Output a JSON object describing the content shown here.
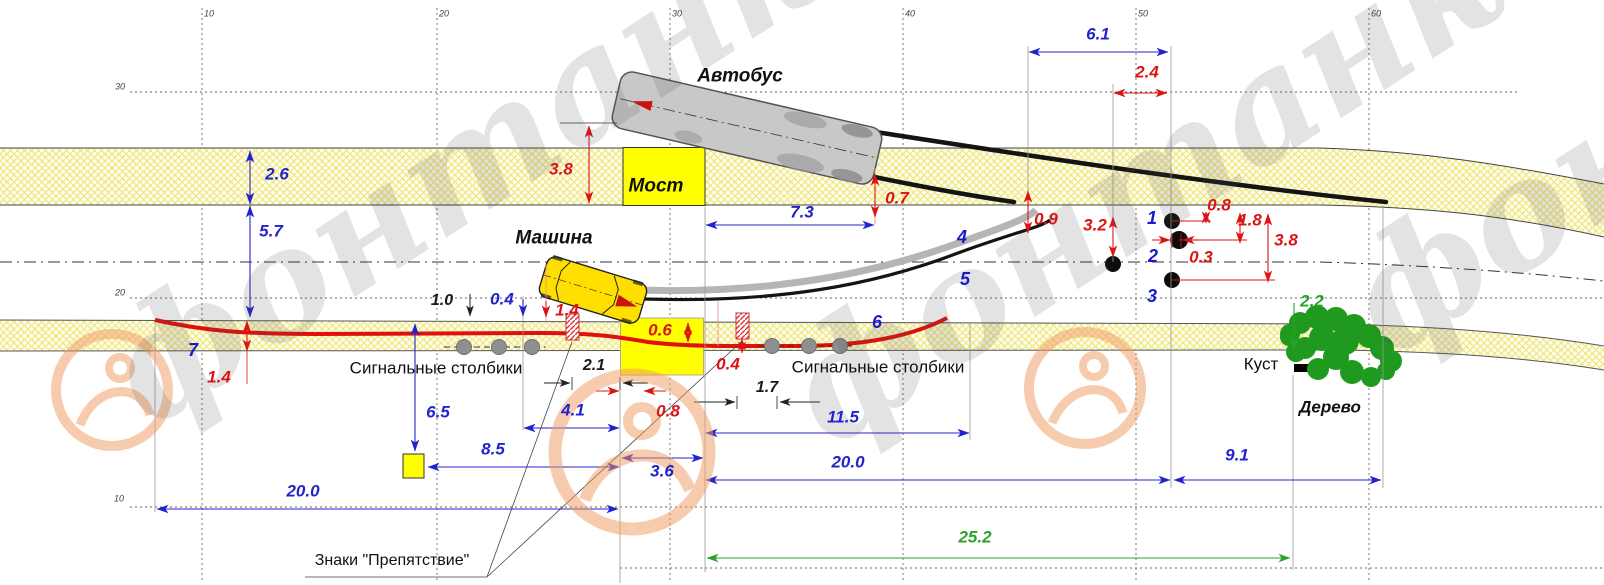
{
  "watermark": {
    "text": "фонтанка.ру"
  },
  "colors": {
    "dimension_blue": "#2323cd",
    "dimension_red": "#dc1414",
    "dimension_green": "#2ba22b",
    "road_fill": "#fffdf0",
    "bridge_yellow": "#ffff00",
    "trajectory_red": "#e01010"
  },
  "axis": {
    "x_ticks": [
      "10",
      "20",
      "30",
      "40",
      "50",
      "60"
    ],
    "y_ticks": [
      "30",
      "20",
      "10"
    ]
  },
  "objects": {
    "bus": "Автобус",
    "bridge": "Мост",
    "car": "Машина",
    "posts": "Сигнальные столбики",
    "obstacle_signs": "Знаки \"Препятствие\"",
    "bush": "Куст",
    "tree": "Дерево"
  },
  "points": [
    "1",
    "2",
    "3"
  ],
  "trajectories": [
    "4",
    "5",
    "6",
    "7"
  ],
  "labels": [
    {
      "id": "axis-x-10",
      "text": "10",
      "x": 209,
      "y": 14,
      "cls": "grid"
    },
    {
      "id": "axis-x-20",
      "text": "20",
      "x": 444,
      "y": 14,
      "cls": "grid"
    },
    {
      "id": "axis-x-30",
      "text": "30",
      "x": 677,
      "y": 14,
      "cls": "grid"
    },
    {
      "id": "axis-x-40",
      "text": "40",
      "x": 910,
      "y": 14,
      "cls": "grid"
    },
    {
      "id": "axis-x-50",
      "text": "50",
      "x": 1143,
      "y": 14,
      "cls": "grid"
    },
    {
      "id": "axis-x-60",
      "text": "60",
      "x": 1376,
      "y": 14,
      "cls": "grid"
    },
    {
      "id": "axis-y-30",
      "text": "30",
      "x": 120,
      "y": 87,
      "cls": "grid"
    },
    {
      "id": "axis-y-20",
      "text": "20",
      "x": 120,
      "y": 293,
      "cls": "grid"
    },
    {
      "id": "axis-y-10",
      "text": "10",
      "x": 119,
      "y": 499,
      "cls": "grid"
    },
    {
      "id": "label-bus",
      "text": "Автобус",
      "x": 740,
      "y": 76,
      "cls": "name"
    },
    {
      "id": "label-bridge",
      "text": "Мост",
      "x": 656,
      "y": 186,
      "cls": "name"
    },
    {
      "id": "label-car",
      "text": "Машина",
      "x": 554,
      "y": 238,
      "cls": "name"
    },
    {
      "id": "label-tree",
      "text": "Дерево",
      "x": 1330,
      "y": 407,
      "cls": "name-sm"
    },
    {
      "id": "label-bush",
      "text": "Куст",
      "x": 1261,
      "y": 364,
      "cls": "plain"
    },
    {
      "id": "label-posts-left",
      "text": "Сигнальные столбики",
      "x": 436,
      "y": 368,
      "cls": "plain"
    },
    {
      "id": "label-posts-right",
      "text": "Сигнальные столбики",
      "x": 878,
      "y": 367,
      "cls": "plain"
    },
    {
      "id": "label-obstacle-signs",
      "text": "Знаки \"Препятствие\"",
      "x": 392,
      "y": 561,
      "cls": "plain-sm"
    },
    {
      "id": "dim-2-6",
      "text": "2.6",
      "x": 277,
      "y": 174,
      "cls": "blue"
    },
    {
      "id": "dim-5-7",
      "text": "5.7",
      "x": 271,
      "y": 231,
      "cls": "blue"
    },
    {
      "id": "dim-7-3",
      "text": "7.3",
      "x": 802,
      "y": 212,
      "cls": "blue"
    },
    {
      "id": "dim-6-1",
      "text": "6.1",
      "x": 1098,
      "y": 34,
      "cls": "blue"
    },
    {
      "id": "dim-0-4-blue",
      "text": "0.4",
      "x": 502,
      "y": 299,
      "cls": "blue"
    },
    {
      "id": "dim-4-1",
      "text": "4.1",
      "x": 573,
      "y": 410,
      "cls": "blue"
    },
    {
      "id": "dim-6-5",
      "text": "6.5",
      "x": 438,
      "y": 412,
      "cls": "blue"
    },
    {
      "id": "dim-8-5",
      "text": "8.5",
      "x": 493,
      "y": 449,
      "cls": "blue"
    },
    {
      "id": "dim-11-5",
      "text": "11.5",
      "x": 843,
      "y": 417,
      "cls": "blue"
    },
    {
      "id": "dim-20-0-right",
      "text": "20.0",
      "x": 848,
      "y": 462,
      "cls": "blue"
    },
    {
      "id": "dim-3-6",
      "text": "3.6",
      "x": 662,
      "y": 471,
      "cls": "blue"
    },
    {
      "id": "dim-20-0-left",
      "text": "20.0",
      "x": 303,
      "y": 491,
      "cls": "blue"
    },
    {
      "id": "dim-9-1",
      "text": "9.1",
      "x": 1237,
      "y": 455,
      "cls": "blue"
    },
    {
      "id": "point-1",
      "text": "1",
      "x": 1152,
      "y": 218,
      "cls": "num"
    },
    {
      "id": "point-2",
      "text": "2",
      "x": 1153,
      "y": 256,
      "cls": "num"
    },
    {
      "id": "point-3",
      "text": "3",
      "x": 1152,
      "y": 296,
      "cls": "num"
    },
    {
      "id": "traj-4",
      "text": "4",
      "x": 962,
      "y": 237,
      "cls": "num"
    },
    {
      "id": "traj-5",
      "text": "5",
      "x": 965,
      "y": 279,
      "cls": "num"
    },
    {
      "id": "traj-6",
      "text": "6",
      "x": 877,
      "y": 322,
      "cls": "num"
    },
    {
      "id": "traj-7",
      "text": "7",
      "x": 193,
      "y": 350,
      "cls": "num"
    },
    {
      "id": "dim-3-8-bus",
      "text": "3.8",
      "x": 561,
      "y": 169,
      "cls": "red"
    },
    {
      "id": "dim-0-7",
      "text": "0.7",
      "x": 897,
      "y": 198,
      "cls": "red"
    },
    {
      "id": "dim-0-9",
      "text": "0.9",
      "x": 1046,
      "y": 219,
      "cls": "red"
    },
    {
      "id": "dim-2-4",
      "text": "2.4",
      "x": 1147,
      "y": 72,
      "cls": "red"
    },
    {
      "id": "dim-3-2",
      "text": "3.2",
      "x": 1095,
      "y": 225,
      "cls": "red"
    },
    {
      "id": "dim-0-8-pt1",
      "text": "0.8",
      "x": 1219,
      "y": 205,
      "cls": "red"
    },
    {
      "id": "dim-1-8-pt2",
      "text": "1.8",
      "x": 1250,
      "y": 220,
      "cls": "red"
    },
    {
      "id": "dim-3-8-pt3",
      "text": "3.8",
      "x": 1286,
      "y": 240,
      "cls": "red"
    },
    {
      "id": "dim-0-3",
      "text": "0.3",
      "x": 1201,
      "y": 257,
      "cls": "red"
    },
    {
      "id": "dim-1-4-mid",
      "text": "1.4",
      "x": 567,
      "y": 310,
      "cls": "red"
    },
    {
      "id": "dim-0-6",
      "text": "0.6",
      "x": 660,
      "y": 330,
      "cls": "red"
    },
    {
      "id": "dim-0-4-red",
      "text": "0.4",
      "x": 728,
      "y": 364,
      "cls": "red"
    },
    {
      "id": "dim-0-8-low",
      "text": "0.8",
      "x": 668,
      "y": 411,
      "cls": "red"
    },
    {
      "id": "dim-1-4-left",
      "text": "1.4",
      "x": 219,
      "y": 377,
      "cls": "red"
    },
    {
      "id": "dim-1-0",
      "text": "1.0",
      "x": 442,
      "y": 301,
      "cls": "bdim"
    },
    {
      "id": "dim-2-1",
      "text": "2.1",
      "x": 594,
      "y": 366,
      "cls": "bdim"
    },
    {
      "id": "dim-1-7",
      "text": "1.7",
      "x": 767,
      "y": 388,
      "cls": "bdim"
    },
    {
      "id": "dim-2-2",
      "text": "2.2",
      "x": 1312,
      "y": 301,
      "cls": "green"
    },
    {
      "id": "dim-25-2",
      "text": "25.2",
      "x": 975,
      "y": 537,
      "cls": "green"
    }
  ]
}
